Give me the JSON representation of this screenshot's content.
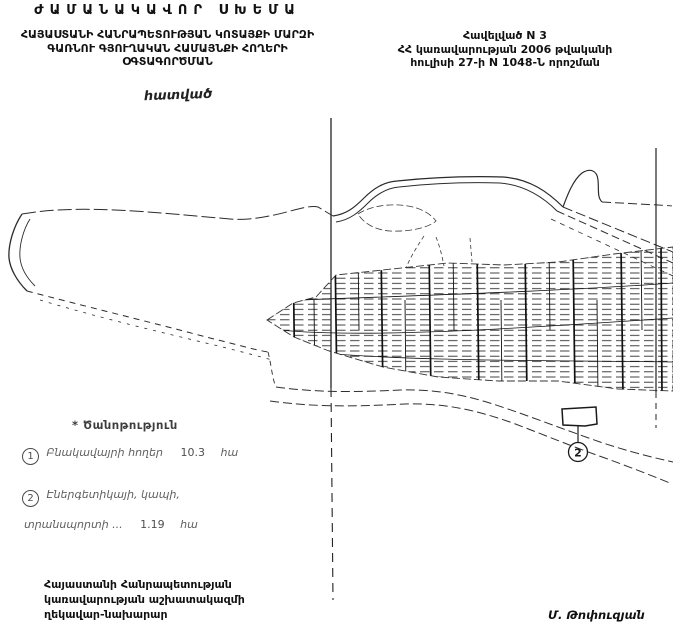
{
  "page": {
    "background": "#ffffff",
    "ink_color": "#1c1c1c",
    "faint_ink": "#5f5f5f"
  },
  "header": {
    "title": "ԺԱՄԱՆԱԿԱՎՈՐ ՍԽԵՄԱ",
    "subtitle_line1": "ՀԱՅԱՍՏԱՆԻ ՀԱՆՐԱՊԵՏՈՒԹՅԱՆ ԿՈՏԱՅՔԻ ՄԱՐԶԻ",
    "subtitle_line2": "ԳԱՌՆՈՒ ԳՅՈՒՂԱԿԱՆ ՀԱՄԱՅՆՔԻ ՀՈՂԵՐԻ",
    "subtitle_line3": "ՕԳՏԱԳՈՐԾՄԱՆ",
    "handwritten_caption": "հատված"
  },
  "annex": {
    "line1": "Հավելված N 3",
    "line2": "ՀՀ կառավարության 2006 թվականի",
    "line3": "հուլիսի 27-ի N 1048-Ն որոշման"
  },
  "map": {
    "callout_label": "2"
  },
  "legend": {
    "note": "* Ծանոթություն",
    "item1": {
      "num": "1",
      "label": "Բնակավայրի հողեր",
      "value": "10.3",
      "unit": "հա"
    },
    "item2": {
      "num": "2",
      "label_line1": "Էներգետիկայի, կապի,",
      "label_line2": "տրանսպորտի ...",
      "value": "1.19",
      "unit": "հա"
    }
  },
  "footer": {
    "office_line1": "Հայաստանի Հանրապետության",
    "office_line2": "կառավարության աշխատակազմի",
    "office_line3": "ղեկավար-նախարար",
    "signatory": "Մ. Թոփուզյան"
  }
}
